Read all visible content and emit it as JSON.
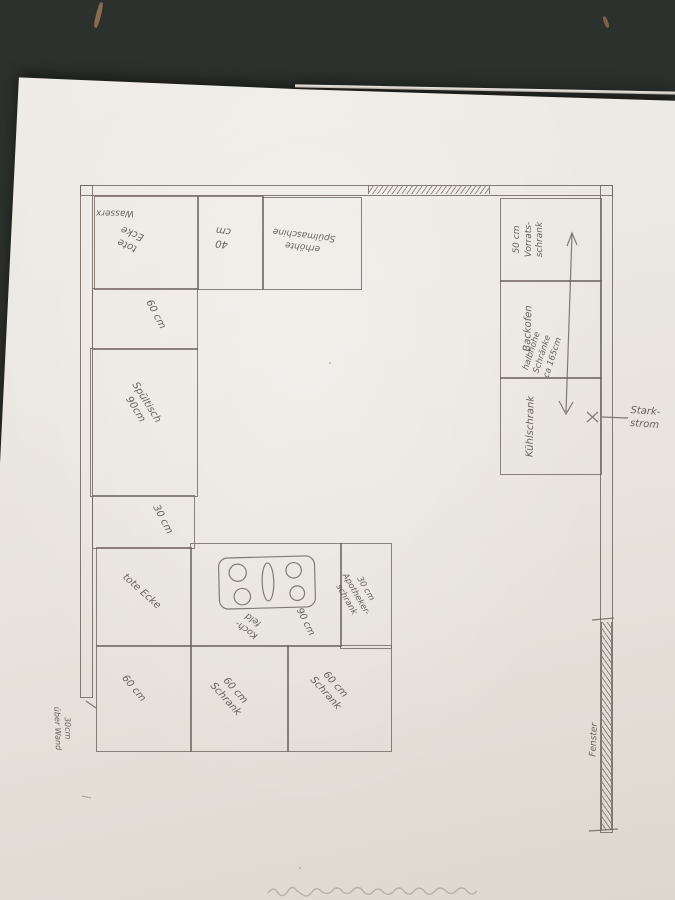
{
  "scene": {
    "description": "Photo of a hand-drawn kitchen floor plan sketch in pencil on white paper, lying upside down on a dark speckled countertop",
    "colors": {
      "pencil": "#6f675f",
      "paper": "#ebe7e1",
      "countertop": "#2d312d"
    }
  },
  "labels": {
    "wasser": "Wasserx",
    "tote_ecke_top": [
      "tote",
      "Ecke"
    ],
    "b40": [
      "40",
      "cm"
    ],
    "spuelmaschine": [
      "erhöhte",
      "Spülmaschine"
    ],
    "vorratsschrank": [
      "50 cm",
      "Vorrats-",
      "schrank"
    ],
    "backofen": "Backofen",
    "kuehlschrank": "Kühlschrank",
    "halbhohe": [
      "halbhohe",
      "Schränke",
      "ca 165cm"
    ],
    "starkstrom": [
      "Stark-",
      "strom"
    ],
    "x_marker": "x",
    "left_60": "60 cm",
    "spueltisch": [
      "Spültisch",
      "90cm"
    ],
    "left_30": "30 cm",
    "tote_ecke_bottom": "tote Ecke",
    "kochfeld": [
      "Koch-",
      "feld"
    ],
    "kochfeld_width": "90 cm",
    "apotheker": [
      "30 cm",
      "Apotheker-",
      "schrank"
    ],
    "bottom_60": "60 cm",
    "bottom_schrank1": [
      "60 cm",
      "Schrank"
    ],
    "bottom_schrank2": [
      "60 cm",
      "Schrank"
    ],
    "ueber_wand": [
      "30cm",
      "über Wand"
    ],
    "fenster": "Fenster"
  }
}
